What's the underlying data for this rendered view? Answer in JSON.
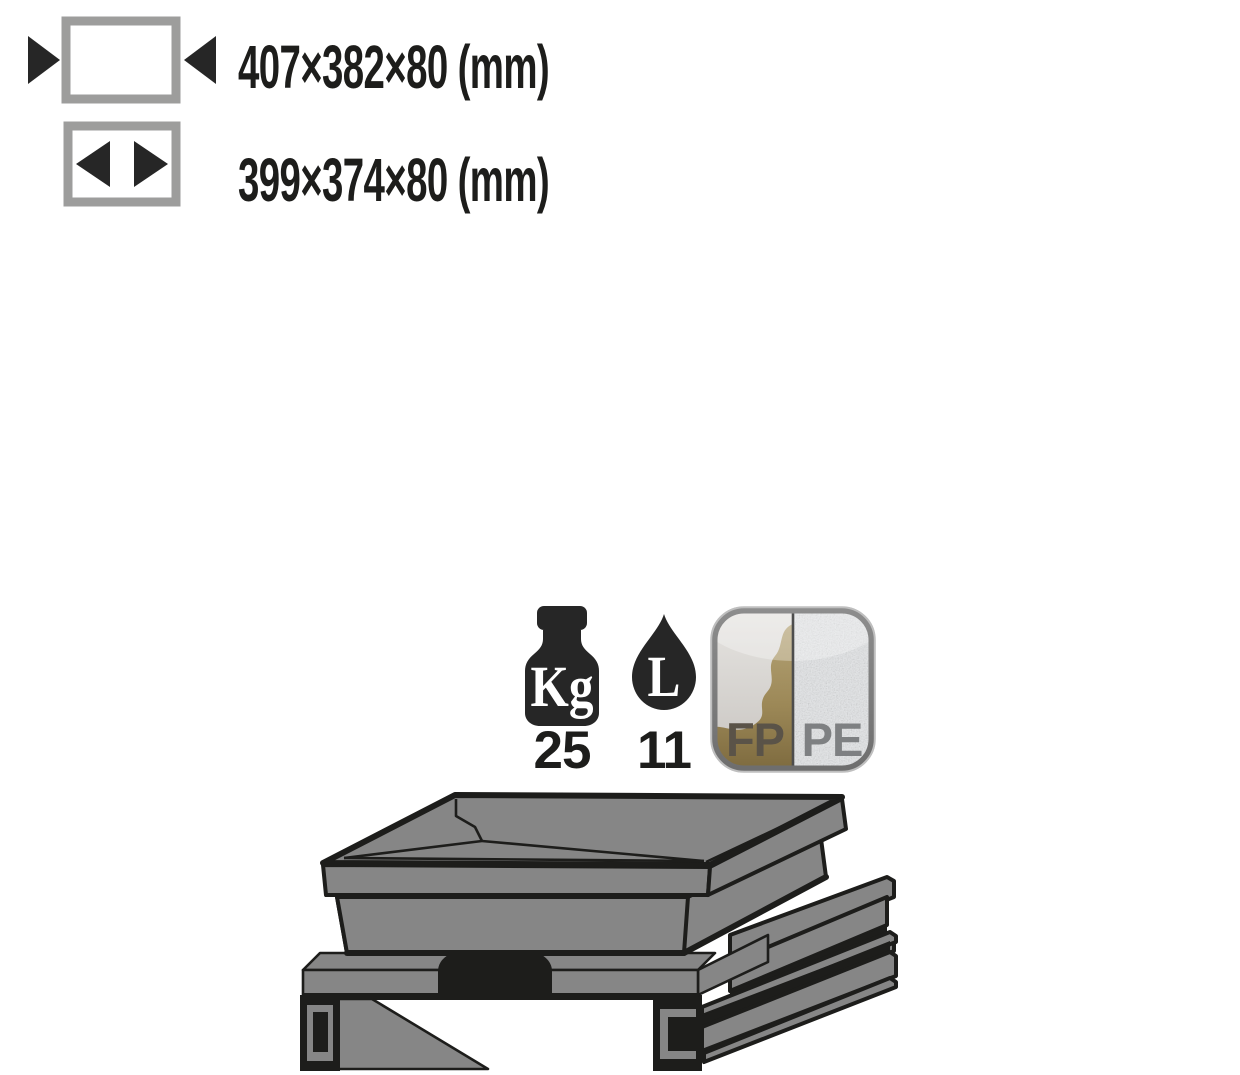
{
  "dimensions": {
    "outer": {
      "value": "407×382×80 (mm)"
    },
    "inner": {
      "value": "399×374×80 (mm)"
    }
  },
  "capacity": {
    "weight": {
      "unit": "Kg",
      "value": "25"
    },
    "volume": {
      "unit": "L",
      "value": "11"
    }
  },
  "materials": {
    "left": "FP",
    "right": "PE"
  },
  "colors": {
    "outline": "#1d1d1b",
    "steel_gray": "#868686",
    "icon_border": "#9d9d9c",
    "pictogram_black": "#262626",
    "gold": "#a3905f",
    "silver": "#e4e6e8",
    "fp_text": "#5a5348",
    "pe_text": "#7e8082"
  }
}
